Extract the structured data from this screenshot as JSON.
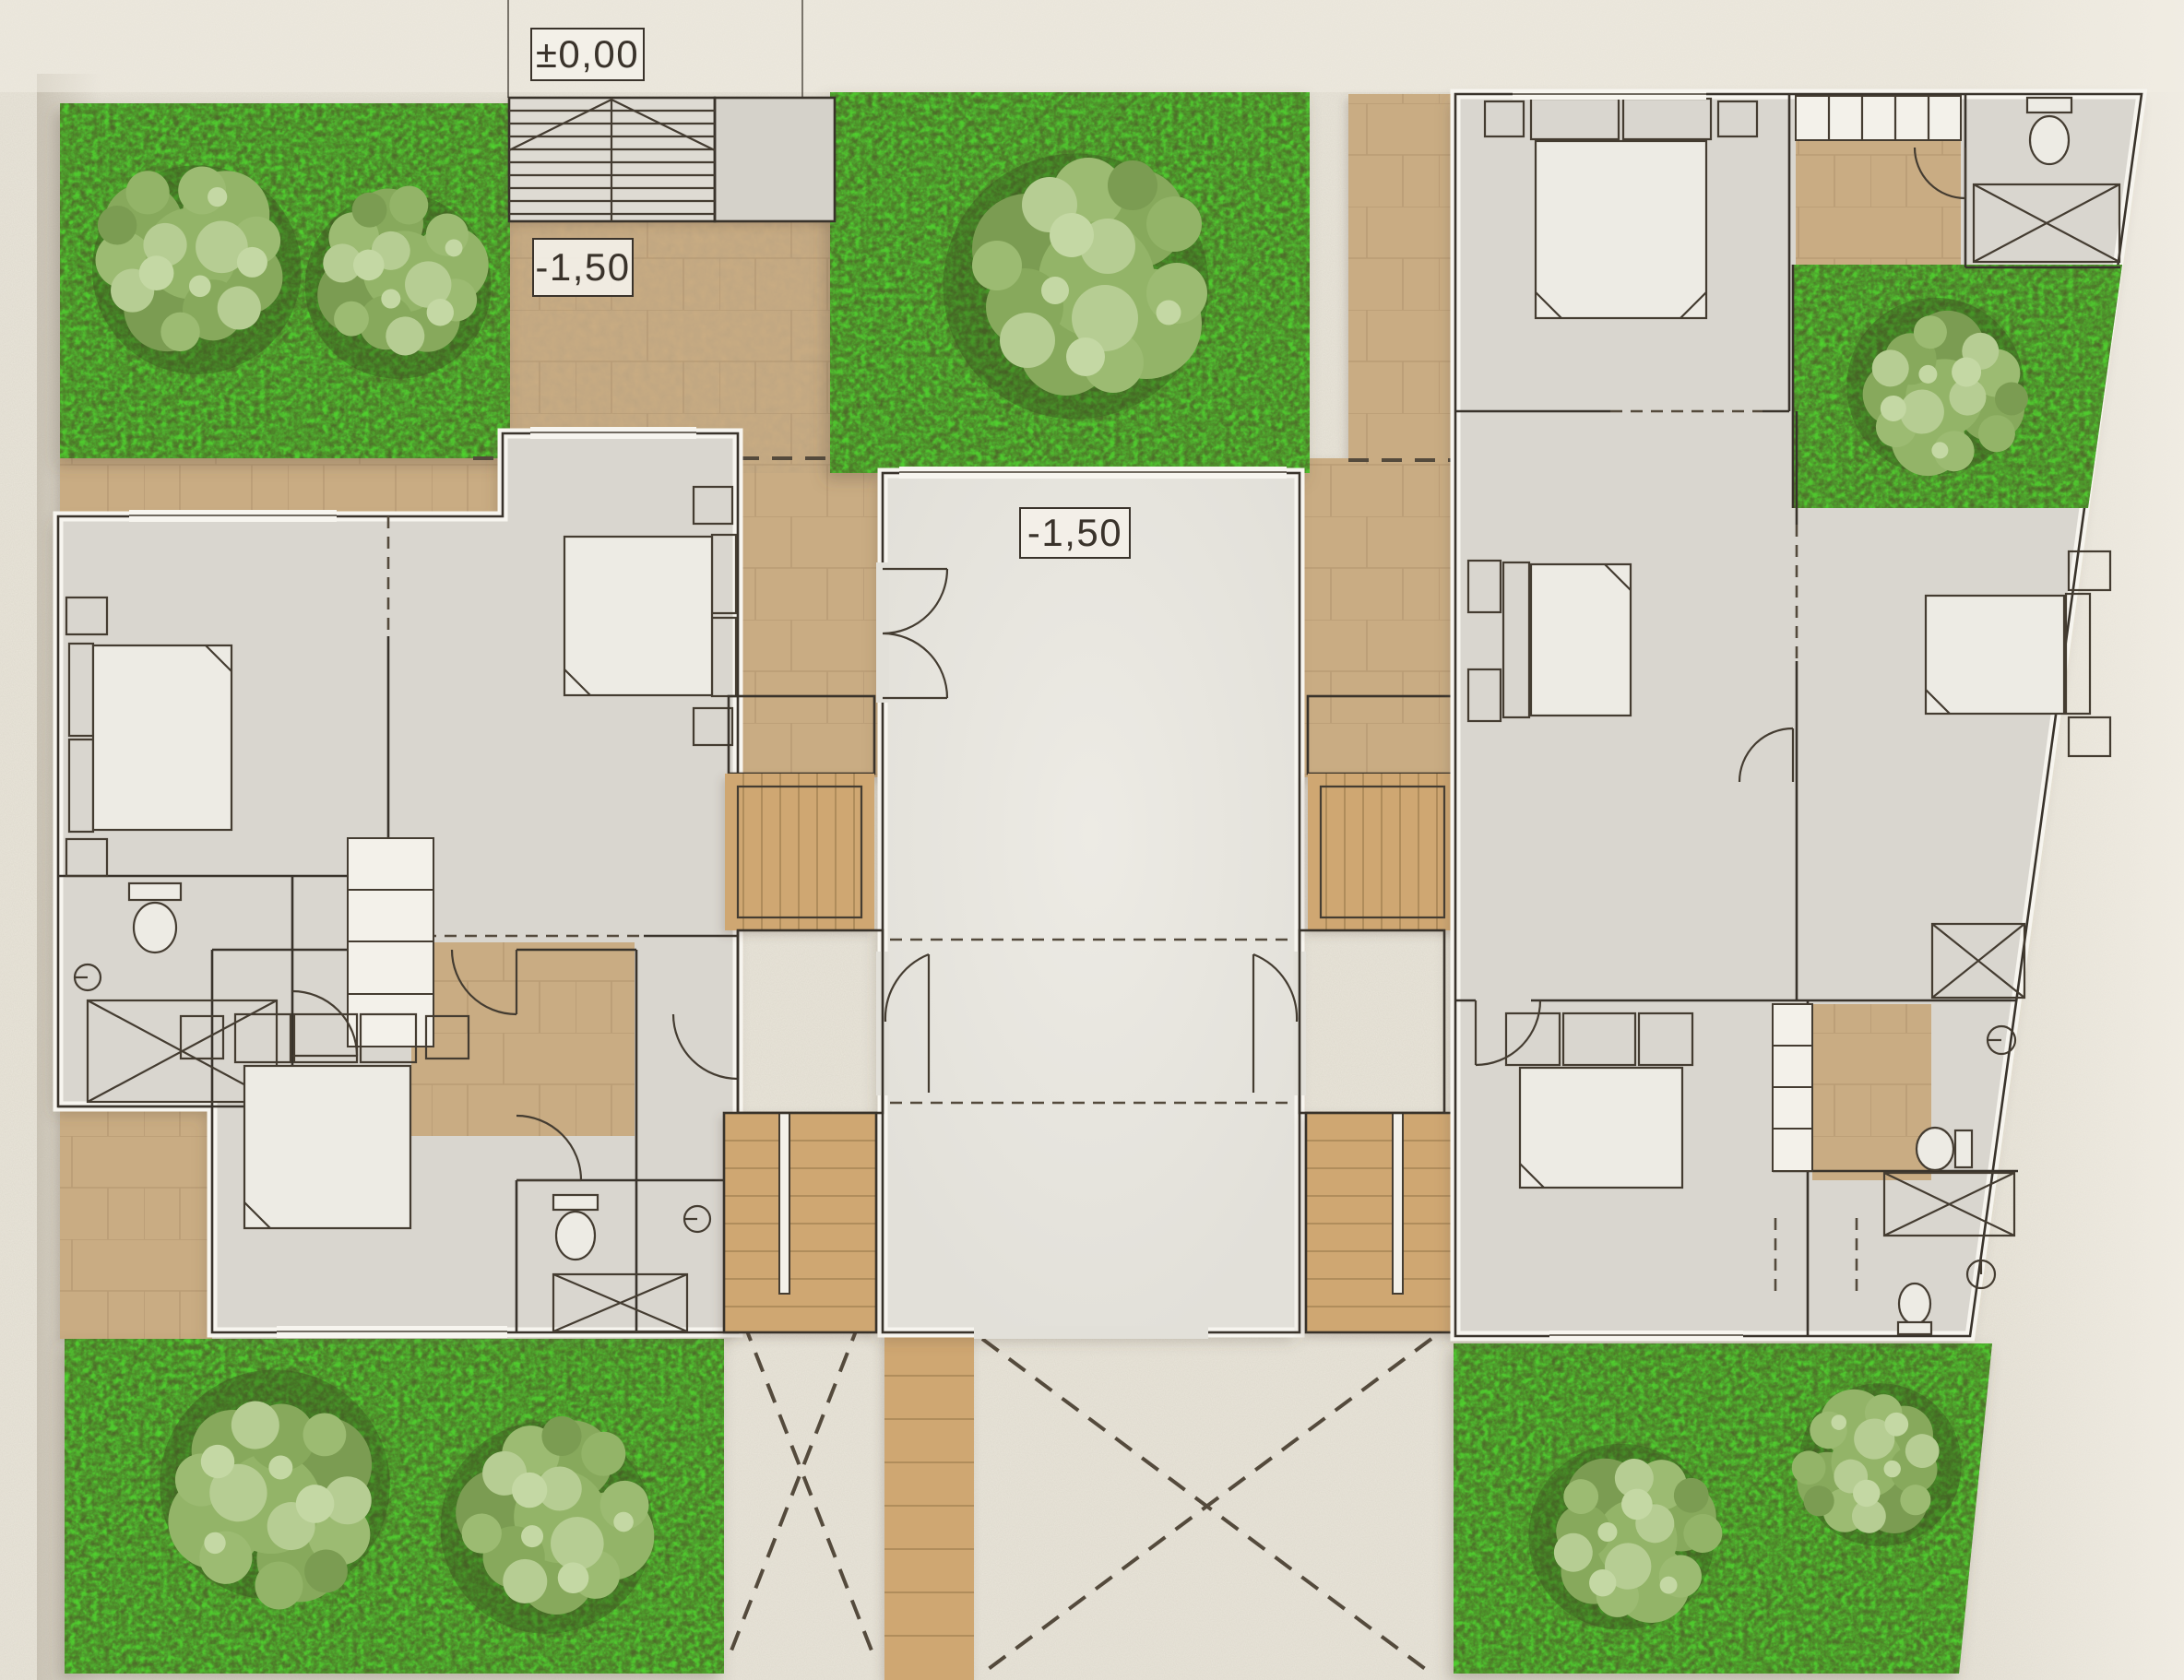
{
  "labels": {
    "elevation_zero": "±0,00",
    "elevation_entry": "-1,50",
    "elevation_courtyard": "-1,50"
  },
  "colors": {
    "paper": "#e9e5da",
    "paper_light": "#f1ede4",
    "paper_shade": "#d8d1c2",
    "slab": "#d9d6cf",
    "slab_light": "#e2e0d9",
    "wall_band": "#f7f5ef",
    "wall_line": "#39332b",
    "furniture": "#443c31",
    "dash": "#544a3c",
    "stone": "#c9ac83",
    "stone_joint": "#ab8e67",
    "wood": "#cfa772",
    "wood_dark": "#9a7a4e",
    "wood_light": "#e2c08c",
    "grass": "#4e6a29",
    "grass_dark": "#3b521e",
    "trunk": "#7a5339"
  },
  "site": {
    "units": 3,
    "grass_patches": 5,
    "trees": 8,
    "interior_staircases": 4,
    "entry_staircases": 1,
    "driveway_cross_marks": 2
  },
  "icons": {
    "tree": "tree-icon",
    "bed": "bed-icon",
    "toilet": "toilet-icon",
    "shower": "shower-icon",
    "water_heater": "heater-icon",
    "door": "door-arc-icon",
    "closet": "closet-icon",
    "stairs": "stairs-icon"
  }
}
